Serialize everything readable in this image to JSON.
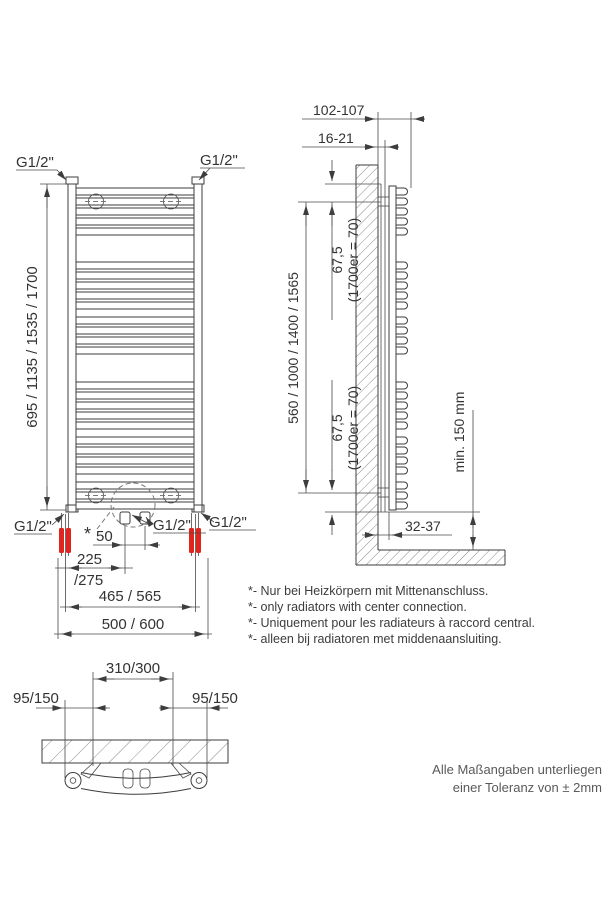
{
  "labels": {
    "g12": "G1/2\""
  },
  "front_view": {
    "height_dim": "695 / 1135 / 1535 / 1700",
    "center_offset_dim": "50",
    "left_center_dim_top": "225",
    "left_center_dim_bottom": "/275",
    "connection_span_dim": "465 / 565",
    "width_dim": "500 / 600",
    "center_note_mark": "*"
  },
  "side_view": {
    "total_depth_dim": "102-107",
    "wall_gap_dim": "16-21",
    "bracket_span_dim": "560 / 1000 / 1400 / 1565",
    "bracket_offset_top": "67,5",
    "bracket_offset_top_note": "(1700er = 70)",
    "bracket_offset_bottom": "67,5",
    "bracket_offset_bottom_note": "(1700er = 70)",
    "floor_clearance_dim": "min. 150 mm",
    "bottom_depth_dim": "32-37"
  },
  "top_view": {
    "bracket_span_dim": "310/300",
    "left_offset_dim": "95/150",
    "right_offset_dim": "95/150"
  },
  "notes": {
    "lines": [
      "*- Nur bei Heizkörpern mit Mittenanschluss.",
      "*- only radiators with center connection.",
      "*- Uniquement pour les radiateurs à raccord central.",
      "*- alleen bij radiatoren met middenaansluiting."
    ]
  },
  "tolerance_note": {
    "line1": "Alle Maßangaben unterliegen",
    "line2": "einer Toleranz von ± 2mm"
  },
  "colors": {
    "line": "#3d3d3d",
    "connection": "#e0251f"
  }
}
